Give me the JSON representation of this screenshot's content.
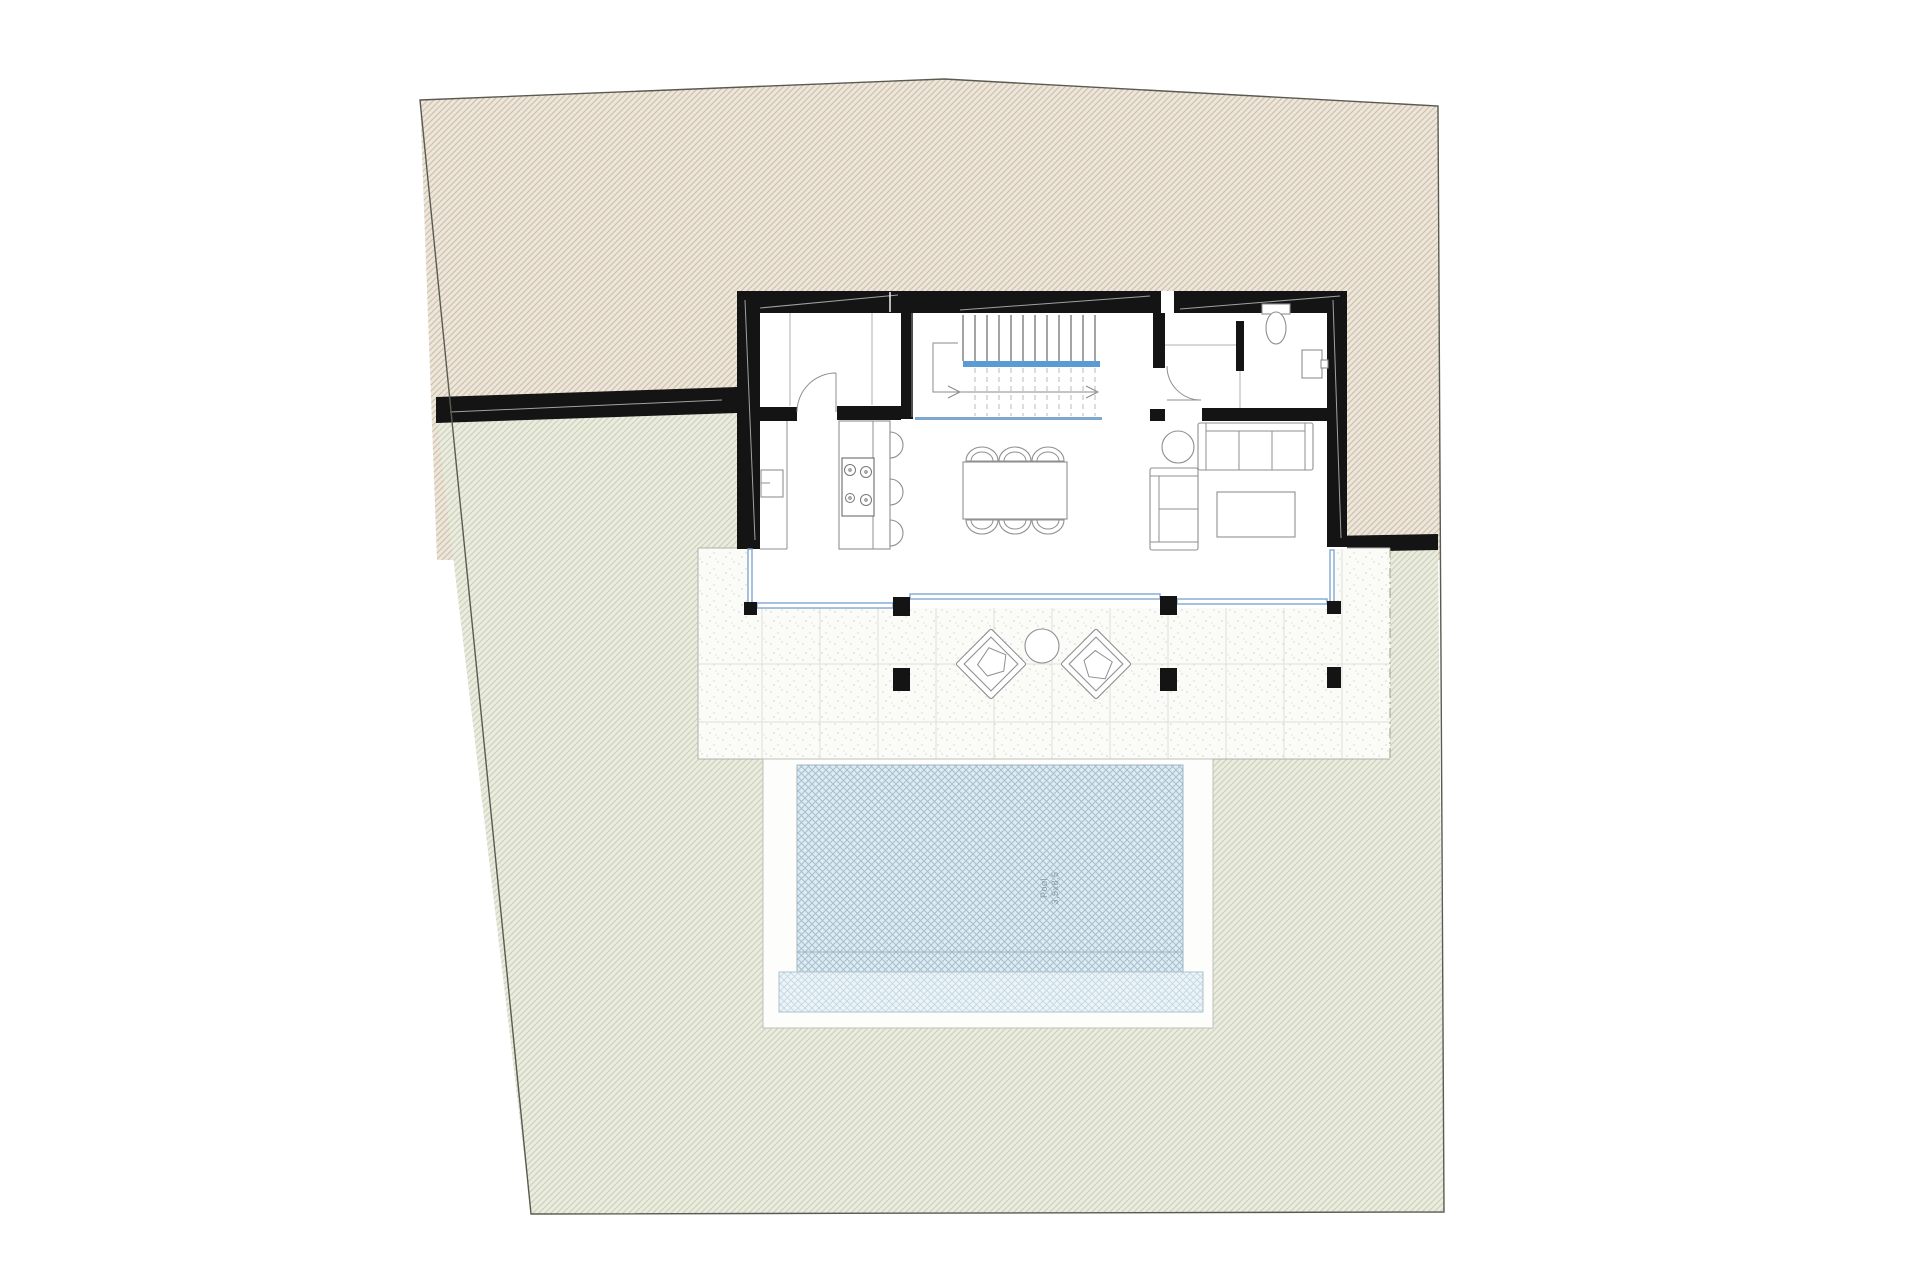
{
  "title": "villa-site-floor-plan",
  "pool": {
    "label_line1": "Pool",
    "label_line2": "3,5x8,5"
  },
  "stairs": {
    "direction": "up",
    "arrowheads": 2
  },
  "colors": {
    "site_beige_bg": "#ede6da",
    "site_beige_line": "#cdbda9",
    "garden_green_bg": "#e9ecdf",
    "garden_green_line": "#c8cfb4",
    "wall": "#141414",
    "glass_blue": "#7fa8cf",
    "stair_blue": "#5b9bd5",
    "pool_water_bg": "#e0ebf1",
    "pool_water_line": "#a3bfcf",
    "pool_shallow_bg": "#edf4f7",
    "pool_shallow_line": "#c2d8e2",
    "terrace_bg": "#fbfbf7",
    "terrace_dot": "#d4d4cb",
    "terrace_grid": "#e0e0d8",
    "furniture_line": "#8f8f8f",
    "boundary": "#5a5a52",
    "pool_text": "#8b9aa6"
  },
  "counts": {
    "dining_chairs": 6,
    "stove_burners": 4,
    "bar_stools": 3,
    "terrace_lounge_chairs": 2,
    "facade_columns": 4,
    "pergola_columns": 3
  }
}
